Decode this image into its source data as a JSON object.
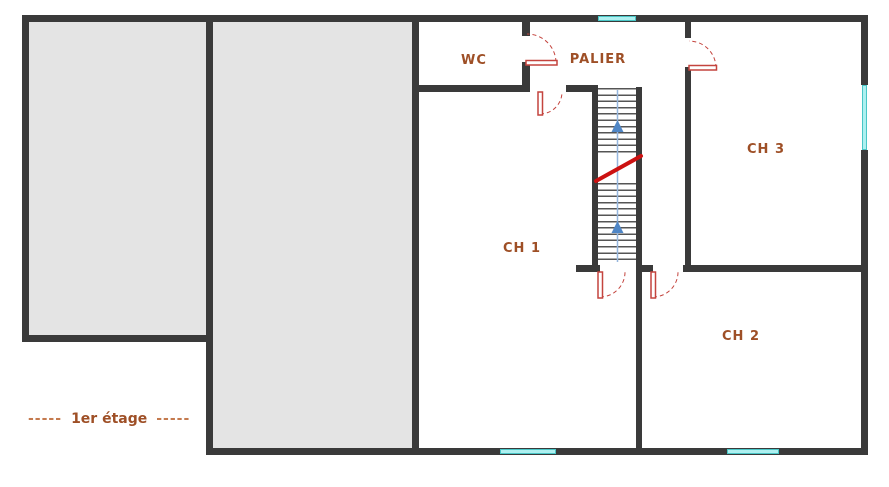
{
  "floor_plan": {
    "floor_label": {
      "prefix_dashes": "-----",
      "text": "1er étage",
      "suffix_dashes": "-----"
    },
    "rooms": {
      "wc": "WC",
      "palier": "PALIER",
      "ch1": "CH 1",
      "ch2": "CH 2",
      "ch3": "CH 3"
    },
    "colors": {
      "wall": "#3a3a3a",
      "room_fill": "#e4e4e4",
      "window": "#aef0f0",
      "window_edge": "#49c6c6",
      "door": "#c4443e",
      "label": "#9e4f26",
      "dash": "#c47a4e",
      "stair_tread": "#555555",
      "stair_line": "#95b6de",
      "stair_arrow": "#4f86c6",
      "break_line": "#cc1111"
    }
  }
}
